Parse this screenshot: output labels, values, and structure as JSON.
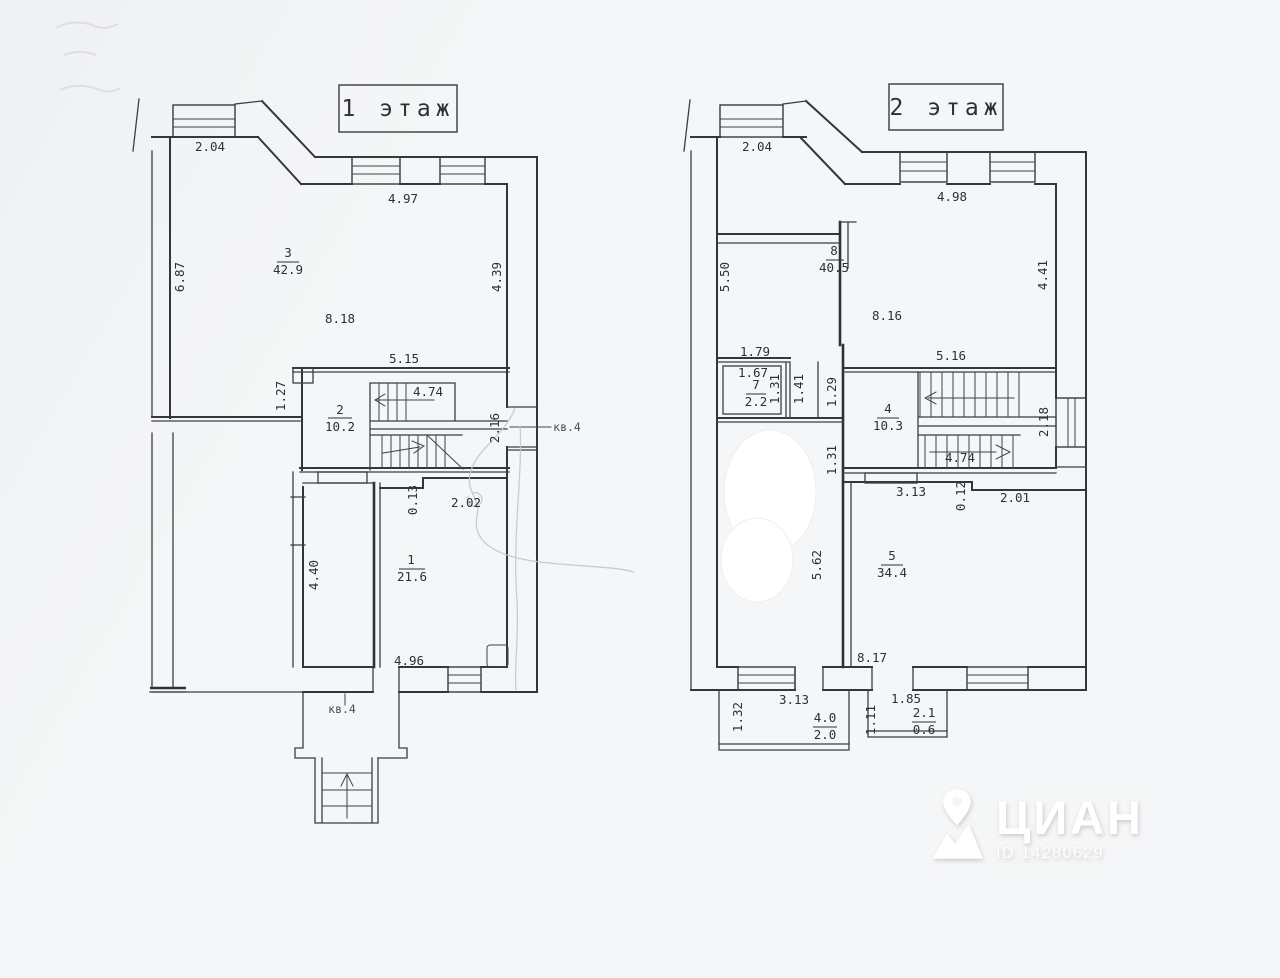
{
  "scan": {
    "watermark": {
      "brand": "ЦИАН",
      "id_text": "ID 14280629"
    }
  },
  "floor1": {
    "title": "1 этаж",
    "door_label": "кв.4",
    "porch_label": "кв.4",
    "rooms": {
      "r3n": "3",
      "r3a": "42.9",
      "r2n": "2",
      "r2a": "10.2",
      "r1n": "1",
      "r1a": "21.6"
    },
    "dims": {
      "d204": "2.04",
      "d497": "4.97",
      "d687": "6.87",
      "d439": "4.39",
      "d818": "8.18",
      "d515": "5.15",
      "d127": "1.27",
      "d474": "4.74",
      "d216": "2.16",
      "d013": "0.13",
      "d202": "2.02",
      "d440": "4.40",
      "d496": "4.96"
    }
  },
  "floor2": {
    "title": "2 этаж",
    "rooms": {
      "r8n": "8",
      "r8a": "40.5",
      "r7n": "7",
      "r7a": "2.2",
      "r4n": "4",
      "r4a": "10.3",
      "r5n": "5",
      "r5a": "34.4",
      "rbn": "4.0",
      "rba": "2.0",
      "rcn": "2.1",
      "rca": "0.6"
    },
    "dims": {
      "d204": "2.04",
      "d498": "4.98",
      "d550": "5.50",
      "d816": "8.16",
      "d441": "4.41",
      "d516": "5.16",
      "d179": "1.79",
      "d167": "1.67",
      "d131a": "1.31",
      "d141": "1.41",
      "d129": "1.29",
      "d218": "2.18",
      "d131b": "1.31",
      "d474": "4.74",
      "d313a": "3.13",
      "d012": "0.12",
      "d201": "2.01",
      "d562": "5.62",
      "d817": "8.17",
      "d313b": "3.13",
      "d132": "1.32",
      "d111": "1.11",
      "d185": "1.85"
    }
  }
}
